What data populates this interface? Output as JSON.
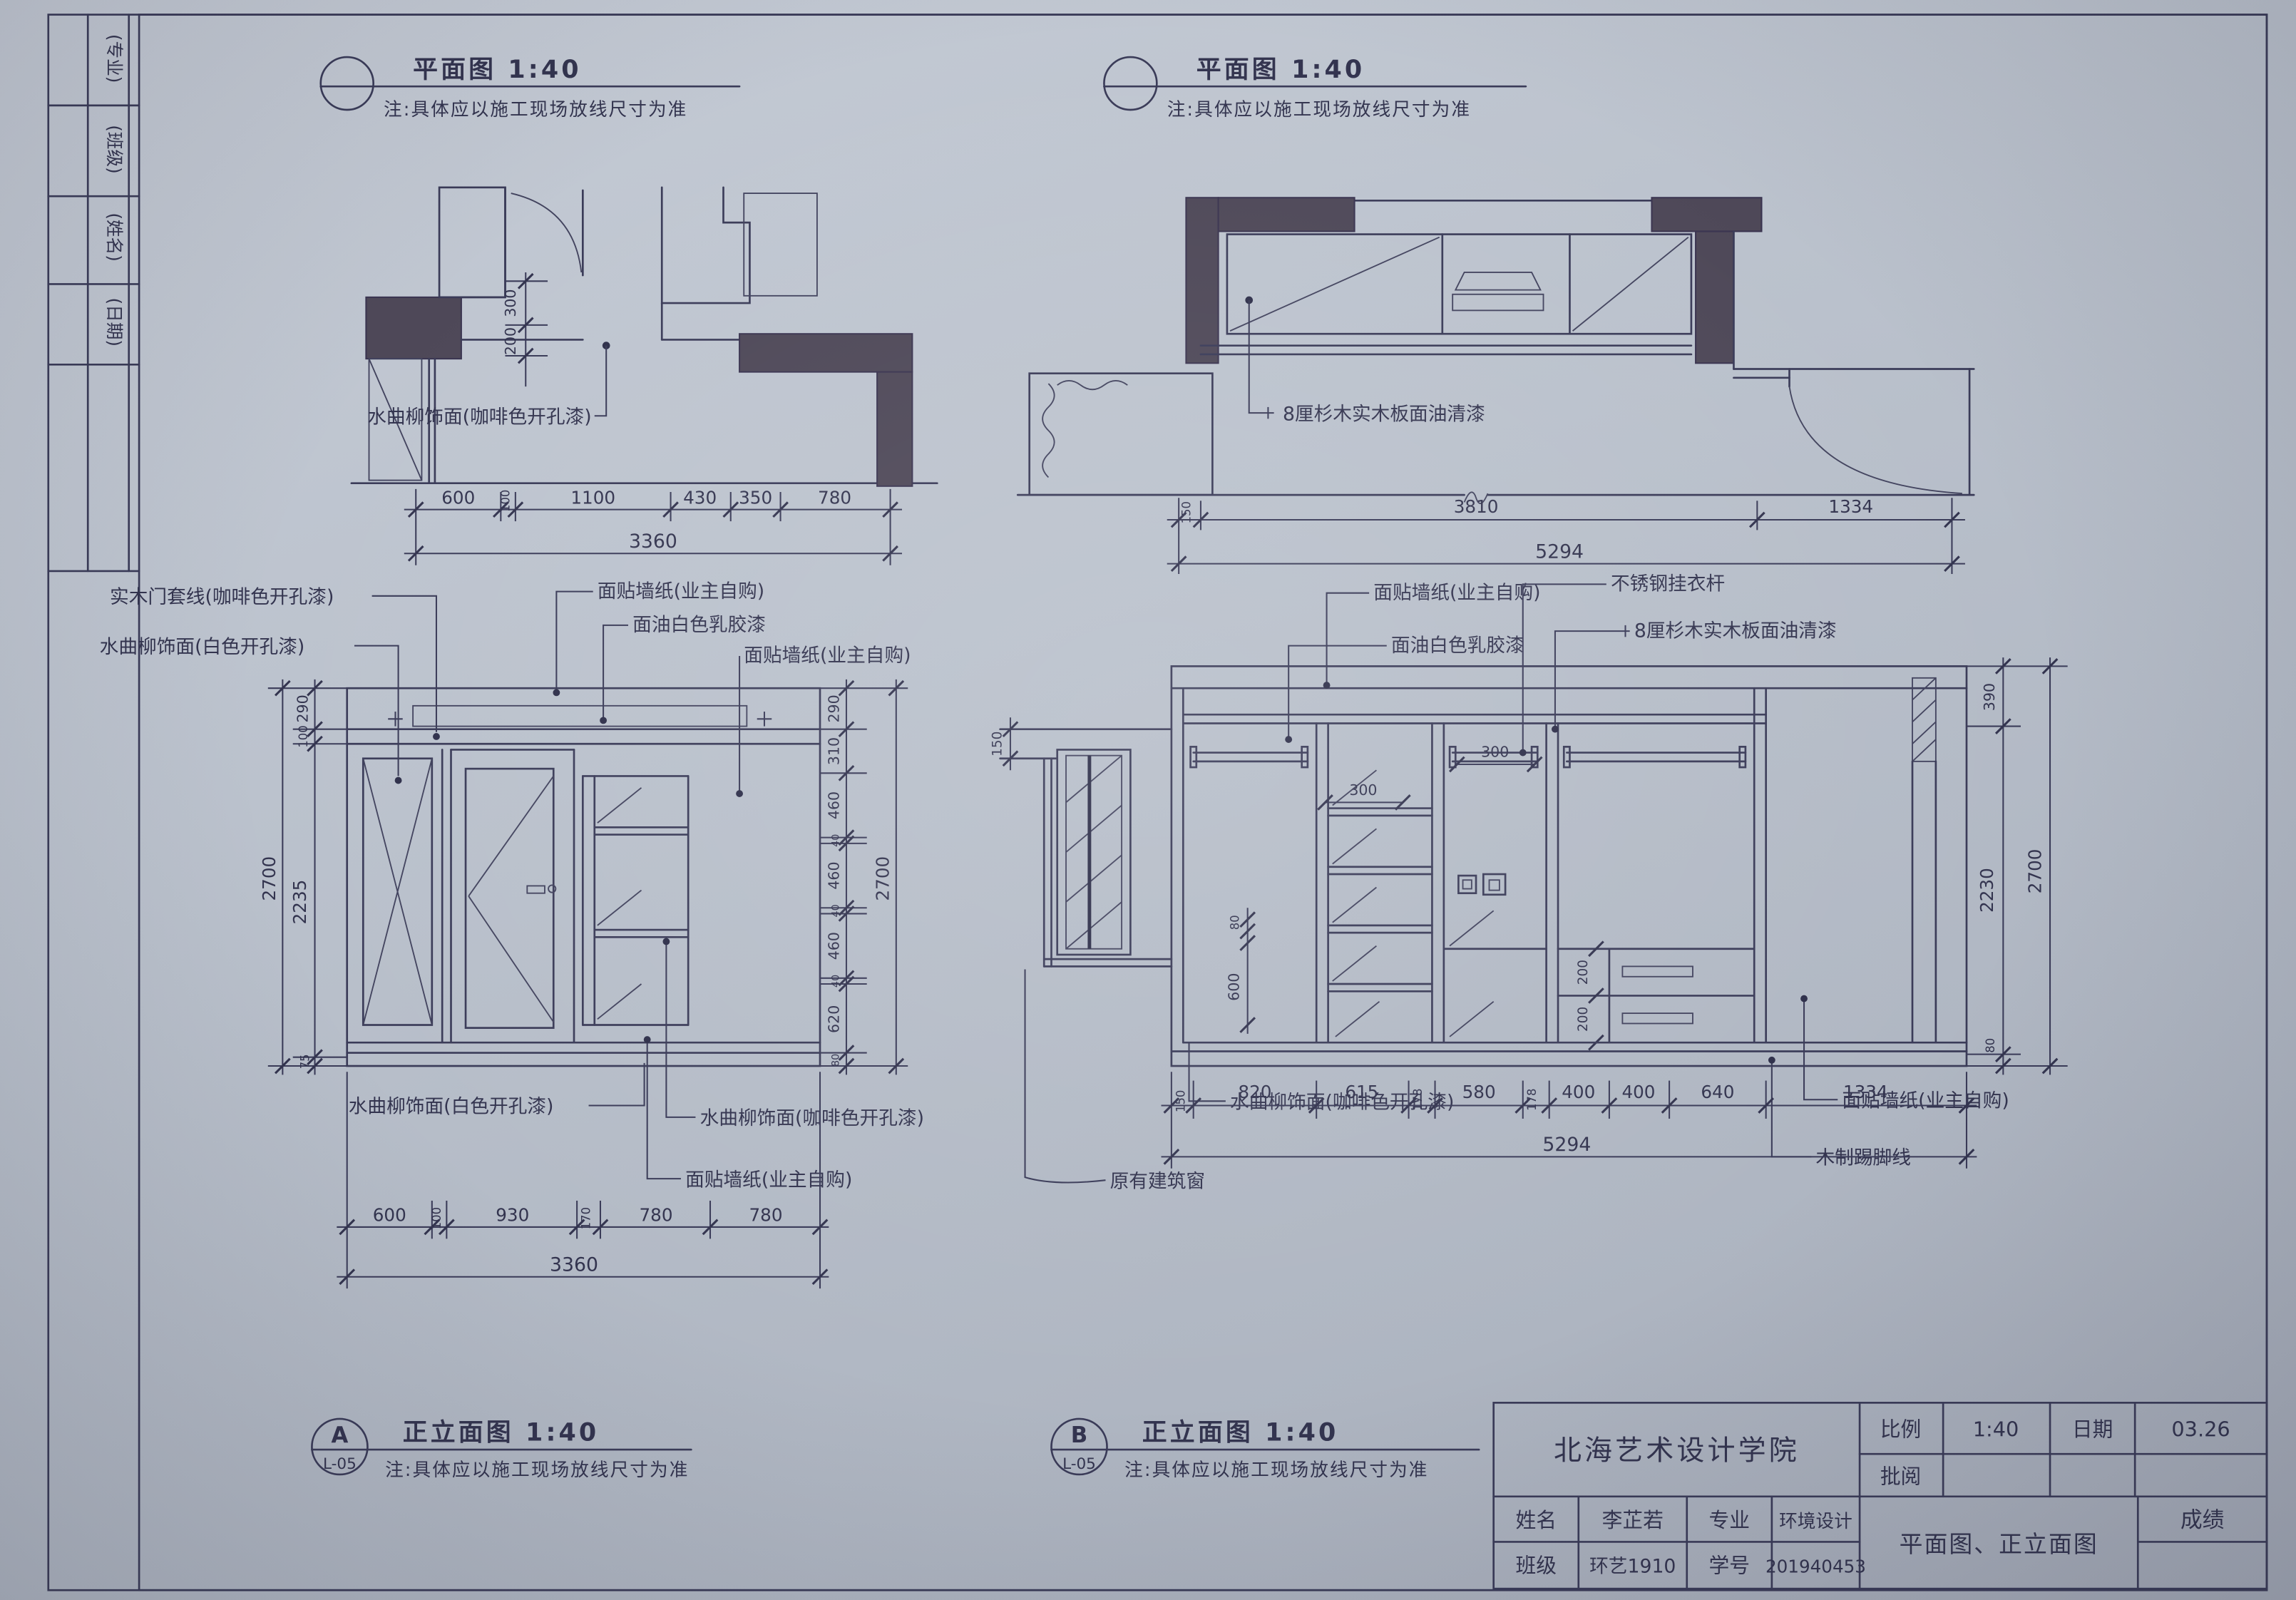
{
  "edge_strip": {
    "cells": [
      "(专业)",
      "(班级)",
      "(姓名)",
      "(日期)"
    ]
  },
  "plan_a": {
    "title": "平面图 1:40",
    "note": "注:具体应以施工现场放线尺寸为准",
    "label_finish": "水曲柳饰面(咖啡色开孔漆)",
    "dims_v": [
      "300",
      "200"
    ],
    "dims": [
      "600",
      "100",
      "1100",
      "430",
      "350",
      "780"
    ],
    "total": "3360"
  },
  "plan_b": {
    "title": "平面图 1:40",
    "note": "注:具体应以施工现场放线尺寸为准",
    "label_finish": "8厘杉木实木板面油清漆",
    "dims": [
      "150",
      "3810",
      "1334"
    ],
    "total": "5294"
  },
  "elev_a": {
    "tag": "A",
    "sheet": "L-05",
    "title": "正立面图 1:40",
    "note": "注:具体应以施工现场放线尺寸为准",
    "labels_top_left": [
      "实木门套线(咖啡色开孔漆)",
      "水曲柳饰面(白色开孔漆)"
    ],
    "labels_top_right": [
      "面贴墙纸(业主自购)",
      "面油白色乳胶漆",
      "面贴墙纸(业主自购)"
    ],
    "labels_bottom": [
      "水曲柳饰面(白色开孔漆)",
      "水曲柳饰面(咖啡色开孔漆)",
      "面贴墙纸(业主自购)"
    ],
    "dims_left": [
      "290",
      "100",
      "2235",
      "75"
    ],
    "dims_left_total": "2700",
    "dims_right": [
      "290",
      "310",
      "460",
      "40",
      "460",
      "40",
      "460",
      "40",
      "620",
      "80"
    ],
    "dims_right_total": "2700",
    "dims_bottom": [
      "600",
      "100",
      "930",
      "170",
      "780",
      "780"
    ],
    "dims_bottom_total": "3360"
  },
  "elev_b": {
    "tag": "B",
    "sheet": "L-05",
    "title": "正立面图 1:40",
    "note": "注:具体应以施工现场放线尺寸为准",
    "labels_top": [
      "面贴墙纸(业主自购)",
      "面油白色乳胶漆",
      "不锈钢挂衣杆",
      "8厘杉木实木板面油清漆"
    ],
    "labels_bottom": [
      "水曲柳饰面(咖啡色开孔漆)",
      "原有建筑窗",
      "面贴墙纸(业主自购)",
      "木制踢脚线"
    ],
    "dim_left": "150",
    "dims_inner": [
      "300",
      "300",
      "80",
      "600",
      "200",
      "200"
    ],
    "dims_right": [
      "390",
      "2230",
      "80"
    ],
    "dims_right_total": "2700",
    "dims_bottom": [
      "150",
      "820",
      "615",
      "178",
      "580",
      "178",
      "400",
      "400",
      "640",
      "1334"
    ],
    "dims_bottom_total": "5294"
  },
  "title_block": {
    "school": "北海艺术设计学院",
    "scale_label": "比例",
    "scale_value": "1:40",
    "date_label": "日期",
    "date_value": "03.26",
    "review_label": "批阅",
    "name_label": "姓名",
    "name_value": "李芷若",
    "major_label": "专业",
    "major_value": "环境设计",
    "class_label": "班级",
    "class_value": "环艺1910",
    "sid_label": "学号",
    "sid_value": "201940453",
    "drawing_title": "平面图、正立面图",
    "grade_label": "成绩"
  },
  "colors": {
    "paper": "#b9c1cb",
    "ink": "#3a3b58",
    "wall": "#4e4858"
  }
}
